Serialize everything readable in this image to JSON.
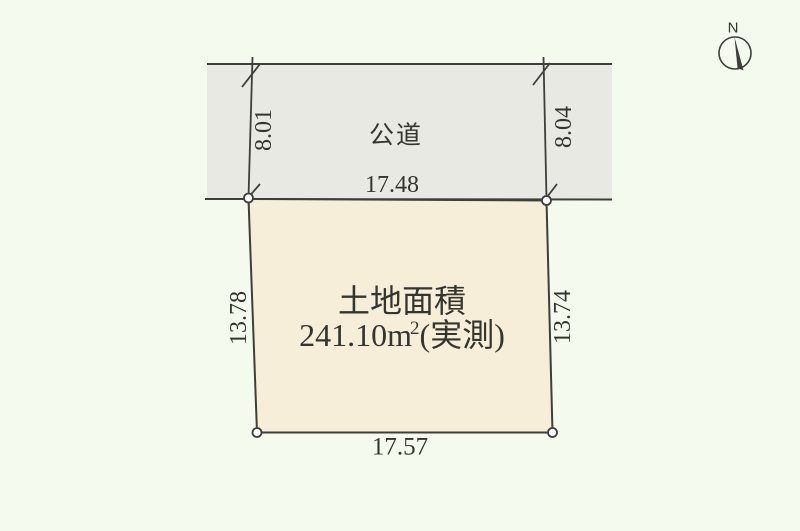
{
  "compass": {
    "north_label": "N"
  },
  "road": {
    "name_label": "公道",
    "frontage_label": "17.48",
    "left_depth_label": "8.01",
    "right_depth_label": "8.04"
  },
  "plot": {
    "area_title": "土地面積",
    "area_value": "241.10m",
    "area_superscript": "2",
    "area_note": "(実測)",
    "left_side_label": "13.78",
    "right_side_label": "13.74",
    "bottom_side_label": "17.57"
  },
  "colors": {
    "background": "#f5faef",
    "road_fill": "#e9e9e4",
    "plot_fill": "#f6eed8",
    "line": "#3f3e3a",
    "text": "#353530"
  }
}
